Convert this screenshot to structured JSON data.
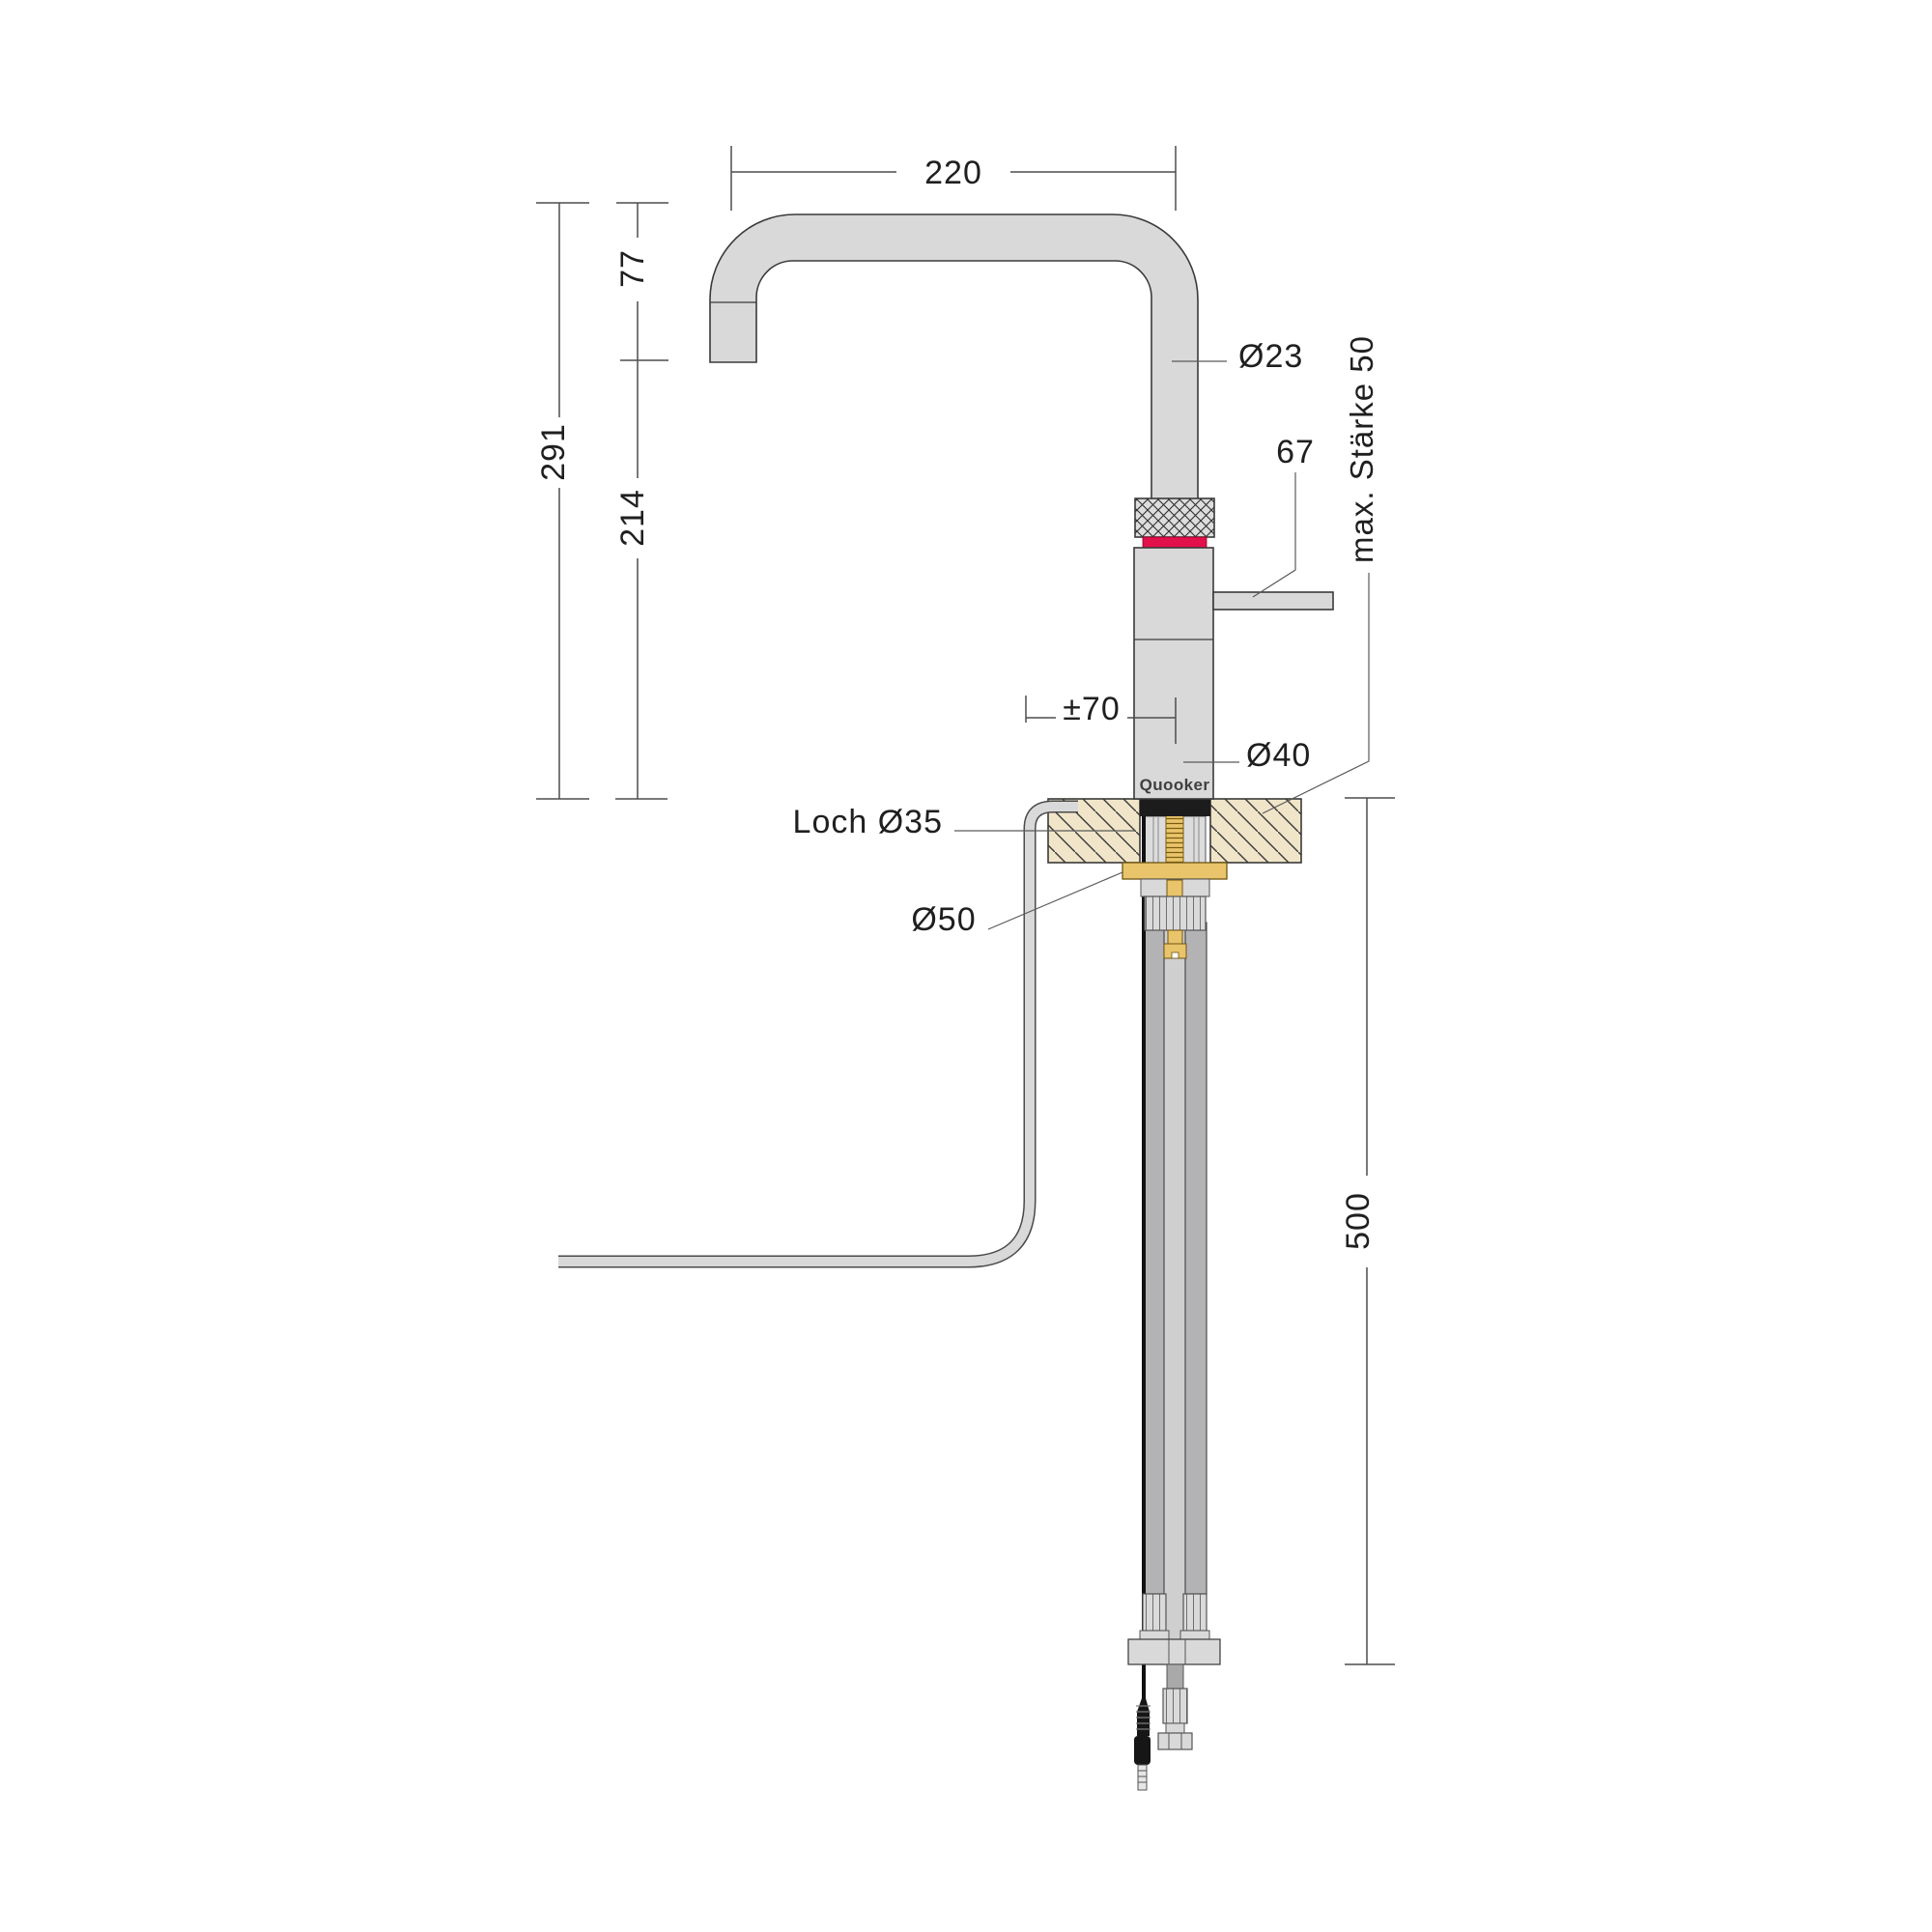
{
  "drawing": {
    "brand_label": "Quooker",
    "labels": {
      "spout_reach": "220",
      "spout_drop": "77",
      "height_total": "291",
      "outlet_height": "214",
      "spout_tube_diameter": "Ø23",
      "handle_length": "67",
      "max_worktop_thickness": "max. Stärke 50",
      "swivel_offset": "±70",
      "body_diameter": "Ø40",
      "hole_diameter": "Loch Ø35",
      "washer_diameter": "Ø50",
      "below_counter_length": "500"
    },
    "colors": {
      "tap_fill": "#d9d9d9",
      "red_ring": "#e2104b",
      "wood": "#f1e5c9",
      "brass": "#e9c46a",
      "hose_dark": "#b3b3b5",
      "outline": "#3a3a3a",
      "dim_line": "#4d4d4d"
    }
  }
}
